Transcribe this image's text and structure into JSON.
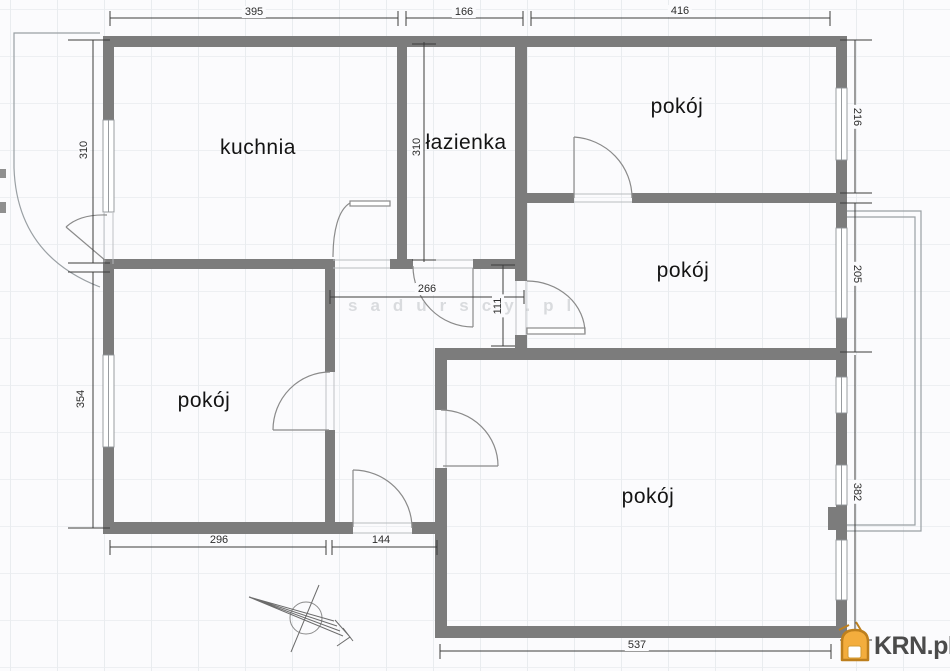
{
  "plan": {
    "type": "apartment-floor-plan",
    "rooms": [
      {
        "id": "kuchnia",
        "label": "kuchnia"
      },
      {
        "id": "lazienka",
        "label": "łazienka"
      },
      {
        "id": "pokoj-top-right",
        "label": "pokój"
      },
      {
        "id": "pokoj-middle-right",
        "label": "pokój"
      },
      {
        "id": "pokoj-bottom-left",
        "label": "pokój"
      },
      {
        "id": "pokoj-bottom",
        "label": "pokój"
      }
    ],
    "dimensions": {
      "top": [
        {
          "label": "395"
        },
        {
          "label": "166"
        },
        {
          "label": "416"
        }
      ],
      "left": [
        {
          "label": "310"
        },
        {
          "label": "354"
        }
      ],
      "right": [
        {
          "label": "216"
        },
        {
          "label": "205"
        },
        {
          "label": "382"
        }
      ],
      "bottom": [
        {
          "label": "296"
        },
        {
          "label": "144"
        },
        {
          "label": "537"
        }
      ],
      "interior": [
        {
          "label": "310"
        },
        {
          "label": "266"
        },
        {
          "label": "111"
        }
      ]
    }
  },
  "watermark": {
    "text": "sadurscy.pl"
  },
  "logo": {
    "text": "KRN.pl"
  },
  "icons": {
    "north_arrow": "compass-north-arrow-icon",
    "logo_icon": "krn-house-icon"
  },
  "colors": {
    "wall": "#7c7c7c",
    "dimension_line": "#3c3c3c",
    "grid": "#e9ecef",
    "watermark": "#d9dbde",
    "logo_icon_fill": "#f3ad3d",
    "logo_icon_stroke": "#bd7f1d",
    "logo_text": "#4b4b4b"
  }
}
